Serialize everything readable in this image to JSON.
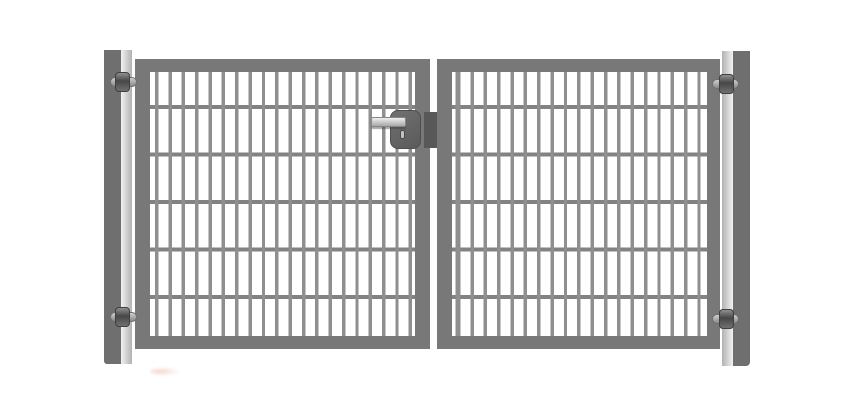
{
  "image": {
    "type": "product-photo",
    "subject": "Grey double-wing metal driveway gate with double-rod mesh infill, two mounting posts, four adjustable hinge bolts, central lock box with handle and keyhole",
    "background": "#ffffff"
  },
  "colors": {
    "background": "#ffffff",
    "frame": "#787878",
    "mesh-vertical": "#8f8f8f",
    "mesh-horizontal": "#828282",
    "post-dark": "#6f6f6f",
    "post-light-1": "#f2f2f2",
    "post-light-2": "#b2b2b2",
    "lock-body-1": "#717171",
    "lock-body-2": "#5a5a5a",
    "lock-edge": "#4e4e4e",
    "latch": "#585858",
    "handle-fill-1": "#efefef",
    "handle-fill-2": "#a8a8a8",
    "handle-edge": "#878787",
    "hinge-nut-1": "#909090",
    "hinge-nut-2": "#474747",
    "hinge-nut-3": "#707070",
    "hinge-shaft-1": "#cfcfcf",
    "hinge-shaft-2": "#8a8a8a",
    "smudge": "rgba(235,162,142,0.45)"
  },
  "structure": {
    "posts": 2,
    "wings": 2,
    "hinges": 4,
    "left_wing": {
      "vertical_bars": 20,
      "horizontal_bars": 5
    },
    "right_wing": {
      "vertical_bars": 19,
      "horizontal_bars": 5
    },
    "lock": {
      "handle": true,
      "keyhole": true,
      "latch": true
    }
  }
}
